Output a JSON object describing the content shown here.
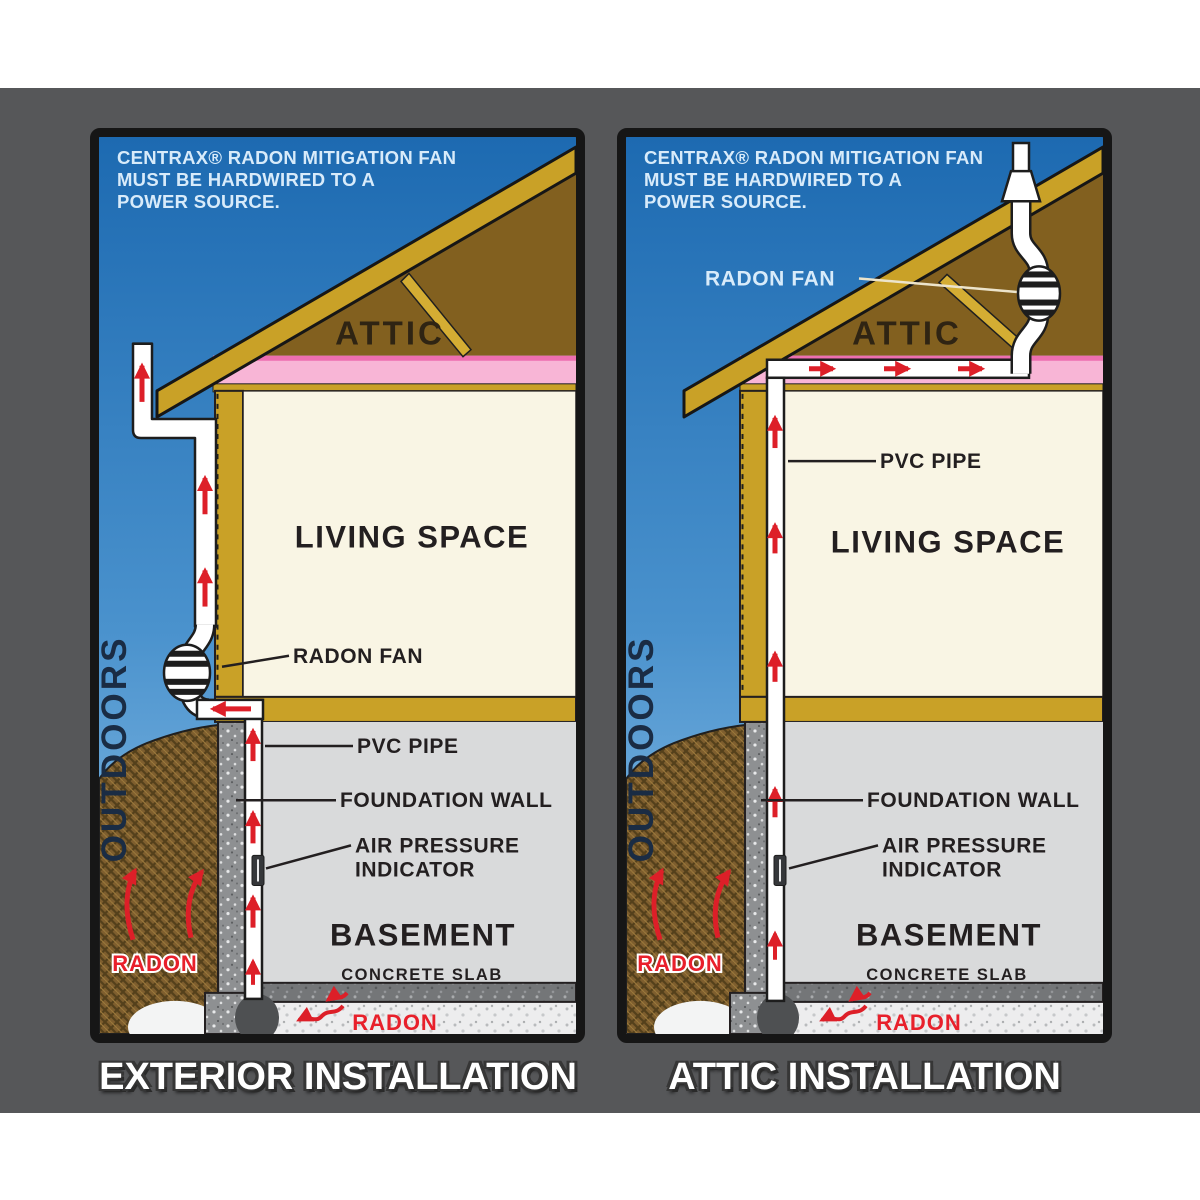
{
  "page": {
    "background": "#ffffff",
    "gray_band": "#565759"
  },
  "colors": {
    "sky_top": "#1d6ab1",
    "sky_bottom": "#94c5ea",
    "structure_gold": "#c9a127",
    "attic_brown": "#82601f",
    "insulation_pink": "#f8b5d6",
    "living_cream": "#f9f5e4",
    "basement_gray": "#d9dadb",
    "foundation_gray": "#8e9092",
    "slab_gray": "#747678",
    "soil_brown": "#7e5e2e",
    "arrow_red": "#dd1f28",
    "radon_red": "#e8202b",
    "caption_blue_white": "#d8ebfa",
    "outdoors_navy": "#1a2c44",
    "label_black": "#231f20",
    "panel_frame": "#161616",
    "title_white": "#ffffff"
  },
  "panels": [
    {
      "name": "exterior-installation",
      "title": "EXTERIOR INSTALLATION",
      "caption": [
        "CENTRAX® RADON MITIGATION FAN",
        "MUST BE HARDWIRED TO A",
        "POWER SOURCE."
      ],
      "labels": {
        "outdoors": "OUTDOORS",
        "attic": "ATTIC",
        "living_space": "LIVING SPACE",
        "radon_fan": "RADON FAN",
        "pvc_pipe": "PVC PIPE",
        "foundation_wall": "FOUNDATION WALL",
        "air_pressure_line1": "AIR PRESSURE",
        "air_pressure_line2": "INDICATOR",
        "basement": "BASEMENT",
        "concrete_slab": "CONCRETE SLAB",
        "radon_soil": "RADON",
        "radon_subslab": "RADON"
      }
    },
    {
      "name": "attic-installation",
      "title": "ATTIC INSTALLATION",
      "caption": [
        "CENTRAX® RADON MITIGATION FAN",
        "MUST BE HARDWIRED TO A",
        "POWER SOURCE."
      ],
      "labels": {
        "outdoors": "OUTDOORS",
        "attic": "ATTIC",
        "living_space": "LIVING SPACE",
        "radon_fan": "RADON FAN",
        "pvc_pipe": "PVC PIPE",
        "foundation_wall": "FOUNDATION WALL",
        "air_pressure_line1": "AIR PRESSURE",
        "air_pressure_line2": "INDICATOR",
        "basement": "BASEMENT",
        "concrete_slab": "CONCRETE SLAB",
        "radon_soil": "RADON",
        "radon_subslab": "RADON"
      }
    }
  ]
}
